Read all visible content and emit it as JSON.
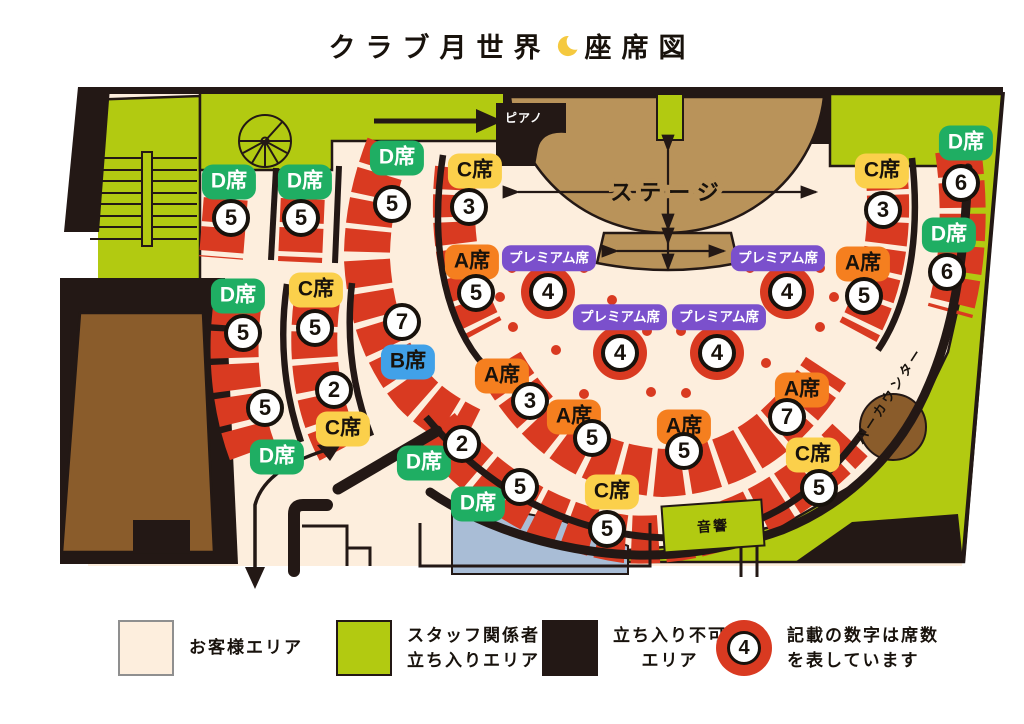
{
  "title": {
    "text_left": "クラブ月世界",
    "moon_icon": "crescent-moon",
    "text_right": "座席図",
    "moon_color": "#f5c93f"
  },
  "map": {
    "labels": {
      "stage": "ステージ",
      "piano": "ピアノ",
      "bar_counter": "バーカウンター",
      "audio": "音響"
    },
    "colors": {
      "customer_floor": "#fdeedd",
      "staff_area_green": "#b2ca11",
      "no_entry_black": "#231815",
      "seat_red": "#d93a21",
      "seat_a_orange": "#f57f1f",
      "seat_b_blue": "#41a1e8",
      "seat_c_yellow": "#fbd04b",
      "seat_d_green": "#1fae63",
      "premium_purple": "#7b50cc",
      "stage_tan": "#b9935a",
      "room_brown": "#8a5c2b",
      "booth_blue": "#a9bdd6"
    },
    "seat_sections": [
      {
        "type": "D",
        "label": "D席",
        "count": "5",
        "bx": 229,
        "by": 182,
        "nx": 231,
        "ny": 218
      },
      {
        "type": "D",
        "label": "D席",
        "count": "5",
        "bx": 305,
        "by": 182,
        "nx": 301,
        "ny": 218
      },
      {
        "type": "D",
        "label": "D席",
        "count": "5",
        "bx": 238,
        "by": 296,
        "nx": 243,
        "ny": 333
      },
      {
        "type": "D",
        "label": "D席",
        "count": "5",
        "bx": 277,
        "by": 457,
        "nx": 265,
        "ny": 408
      },
      {
        "type": "C",
        "label": "C席",
        "count": "5",
        "bx": 316,
        "by": 290,
        "nx": 315,
        "ny": 328
      },
      {
        "type": "C",
        "label": "C席",
        "count": "2",
        "bx": 343,
        "by": 429,
        "nx": 334,
        "ny": 390
      },
      {
        "type": "D",
        "label": "D席",
        "count": "5",
        "bx": 397,
        "by": 158,
        "nx": 392,
        "ny": 204
      },
      {
        "type": "B",
        "label": "B席",
        "count": "7",
        "bx": 408,
        "by": 362,
        "nx": 402,
        "ny": 322
      },
      {
        "type": "C",
        "label": "C席",
        "count": "3",
        "bx": 475,
        "by": 171,
        "nx": 469,
        "ny": 207
      },
      {
        "type": "A",
        "label": "A席",
        "count": "5",
        "bx": 472,
        "by": 262,
        "nx": 476,
        "ny": 293
      },
      {
        "type": "P",
        "label": "プレミアム席",
        "count": "4",
        "bx": 549,
        "by": 258,
        "nx": 548,
        "ny": 292
      },
      {
        "type": "P",
        "label": "プレミアム席",
        "count": "4",
        "bx": 778,
        "by": 258,
        "nx": 787,
        "ny": 292
      },
      {
        "type": "P",
        "label": "プレミアム席",
        "count": "4",
        "bx": 620,
        "by": 317,
        "nx": 620,
        "ny": 353
      },
      {
        "type": "P",
        "label": "プレミアム席",
        "count": "4",
        "bx": 719,
        "by": 317,
        "nx": 717,
        "ny": 353
      },
      {
        "type": "A",
        "label": "A席",
        "count": "5",
        "bx": 863,
        "by": 264,
        "nx": 864,
        "ny": 296
      },
      {
        "type": "C",
        "label": "C席",
        "count": "3",
        "bx": 882,
        "by": 171,
        "nx": 883,
        "ny": 210
      },
      {
        "type": "D",
        "label": "D席",
        "count": "6",
        "bx": 966,
        "by": 143,
        "nx": 961,
        "ny": 183
      },
      {
        "type": "D",
        "label": "D席",
        "count": "6",
        "bx": 949,
        "by": 235,
        "nx": 947,
        "ny": 272
      },
      {
        "type": "A",
        "label": "A席",
        "count": "3",
        "bx": 502,
        "by": 376,
        "nx": 530,
        "ny": 401
      },
      {
        "type": "A",
        "label": "A席",
        "count": "5",
        "bx": 574,
        "by": 417,
        "nx": 592,
        "ny": 438
      },
      {
        "type": "A",
        "label": "A席",
        "count": "5",
        "bx": 684,
        "by": 427,
        "nx": 684,
        "ny": 451
      },
      {
        "type": "A",
        "label": "A席",
        "count": "7",
        "bx": 802,
        "by": 390,
        "nx": 787,
        "ny": 417
      },
      {
        "type": "D",
        "label": "D席",
        "count": "2",
        "bx": 424,
        "by": 463,
        "nx": 462,
        "ny": 444
      },
      {
        "type": "D",
        "label": "D席",
        "count": "5",
        "bx": 478,
        "by": 504,
        "nx": 520,
        "ny": 487
      },
      {
        "type": "C",
        "label": "C席",
        "count": "5",
        "bx": 612,
        "by": 492,
        "nx": 607,
        "ny": 529
      },
      {
        "type": "C",
        "label": "C席",
        "count": "5",
        "bx": 813,
        "by": 455,
        "nx": 819,
        "ny": 488
      }
    ]
  },
  "legend": {
    "items": [
      {
        "name": "customer-area",
        "lines": [
          "お客様エリア"
        ]
      },
      {
        "name": "staff-area",
        "lines": [
          "スタッフ関係者",
          "立ち入りエリア"
        ]
      },
      {
        "name": "no-entry-area",
        "lines": [
          "立ち入り不可",
          "エリア"
        ]
      },
      {
        "name": "seat-count-note",
        "value": "4",
        "lines": [
          "記載の数字は席数",
          "を表しています"
        ]
      }
    ]
  }
}
